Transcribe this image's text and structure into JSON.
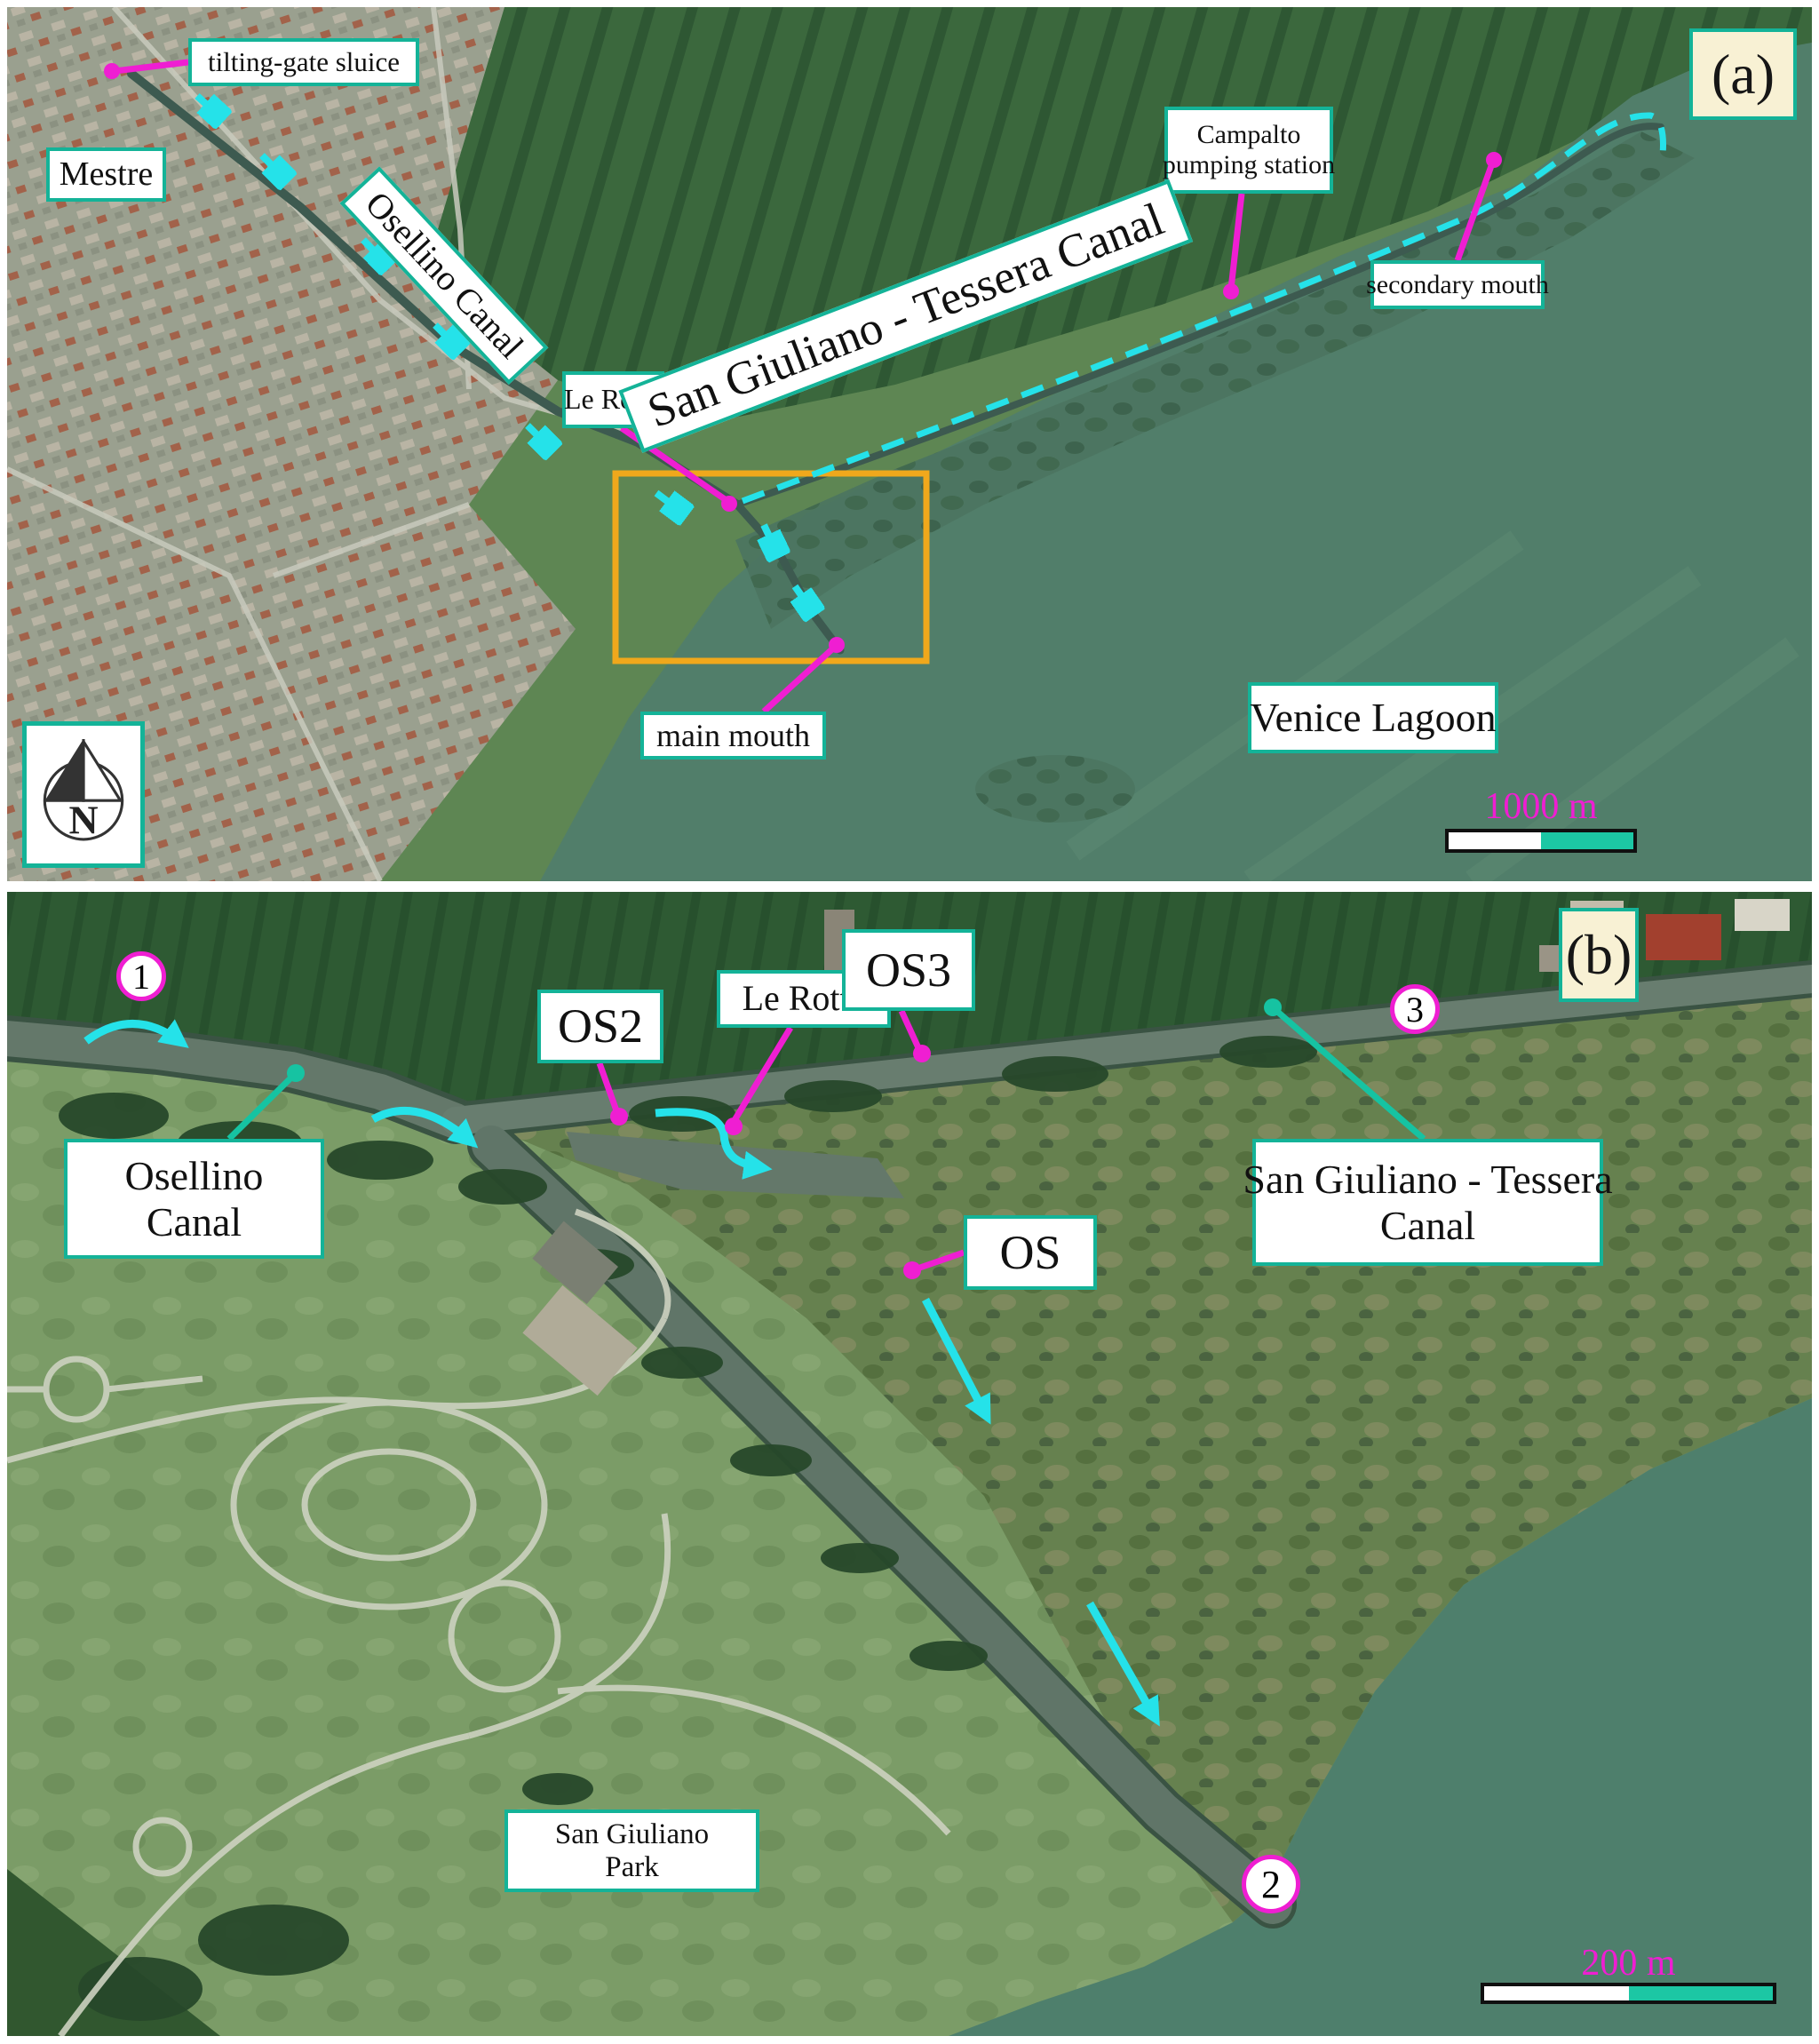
{
  "figure": {
    "panel_a": {
      "marker": "(a)",
      "north_label": "N",
      "scale_label": "1000 m",
      "labels": {
        "tilting_gate_sluice": "tilting-gate sluice",
        "mestre": "Mestre",
        "osellino_canal": "Osellino Canal",
        "le_rotte": "Le Rotte",
        "campalto_line1": "Campalto",
        "campalto_line2": "pumping station",
        "san_giuliano_tessera": "San Giuliano - Tessera Canal",
        "secondary_mouth": "secondary mouth",
        "main_mouth": "main mouth",
        "venice_lagoon": "Venice Lagoon"
      }
    },
    "panel_b": {
      "marker": "(b)",
      "scale_label": "200 m",
      "labels": {
        "osellino_line1": "Osellino",
        "osellino_line2": "Canal",
        "os2": "OS2",
        "le_rotte": "Le Rotte",
        "os3": "OS3",
        "os": "OS",
        "sgt_line1": "San Giuliano - Tessera",
        "sgt_line2": "Canal",
        "park_line1": "San Giuliano",
        "park_line2": "Park"
      },
      "points": {
        "p1": "1",
        "p2": "2",
        "p3": "3"
      }
    },
    "colors": {
      "label_border_teal": "#14b398",
      "leader_magenta": "#ef1ed2",
      "arrow_cyan": "#25e2e9",
      "teal_leader": "#16c3a2",
      "orange_box": "#f0a81c",
      "marker_bg_cream": "#f8f1d4",
      "scalebar_teal": "#1cc7a4"
    }
  }
}
